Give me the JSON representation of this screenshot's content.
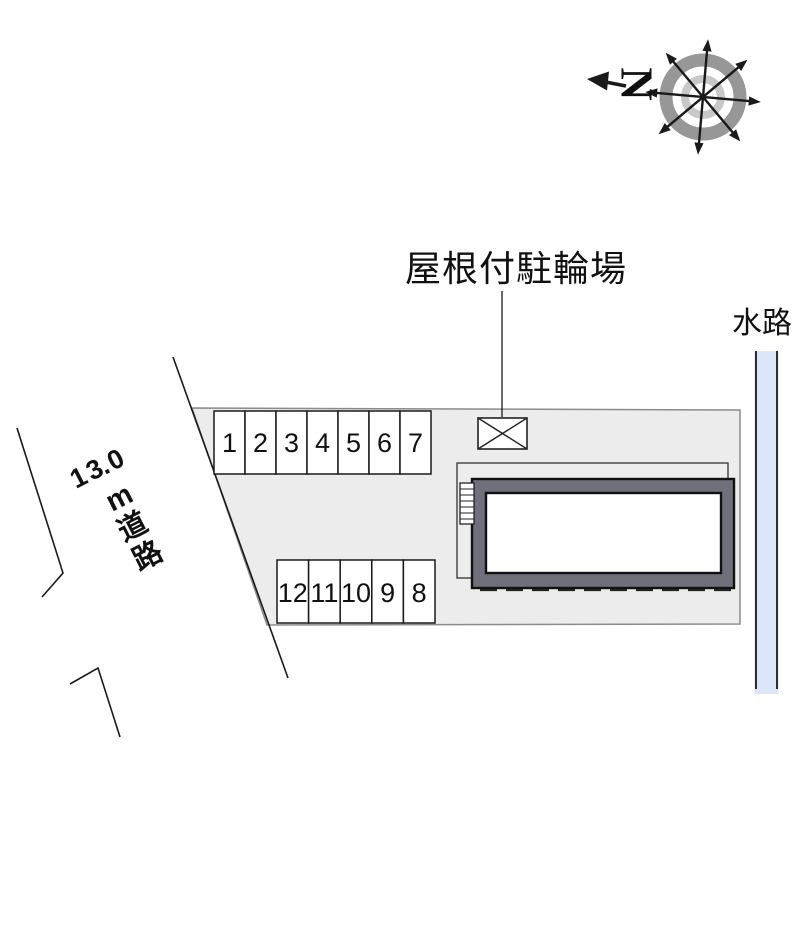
{
  "compass": {
    "north_label": "N"
  },
  "labels": {
    "covered_bicycle_parking": "屋根付駐輪場",
    "waterway": "水路",
    "road_width": "13.0",
    "road_name": "m道路"
  },
  "parking": {
    "row_top": [
      "1",
      "2",
      "3",
      "4",
      "5",
      "6",
      "7"
    ],
    "row_bottom": [
      "12",
      "11",
      "10",
      "9",
      "8"
    ]
  },
  "colors": {
    "plot_fill": "#ececec",
    "canopy_fill": "#ededed",
    "building_frame": "#70707a",
    "building_inner": "#ffffff",
    "waterway_fill": "#dbe7f8"
  }
}
